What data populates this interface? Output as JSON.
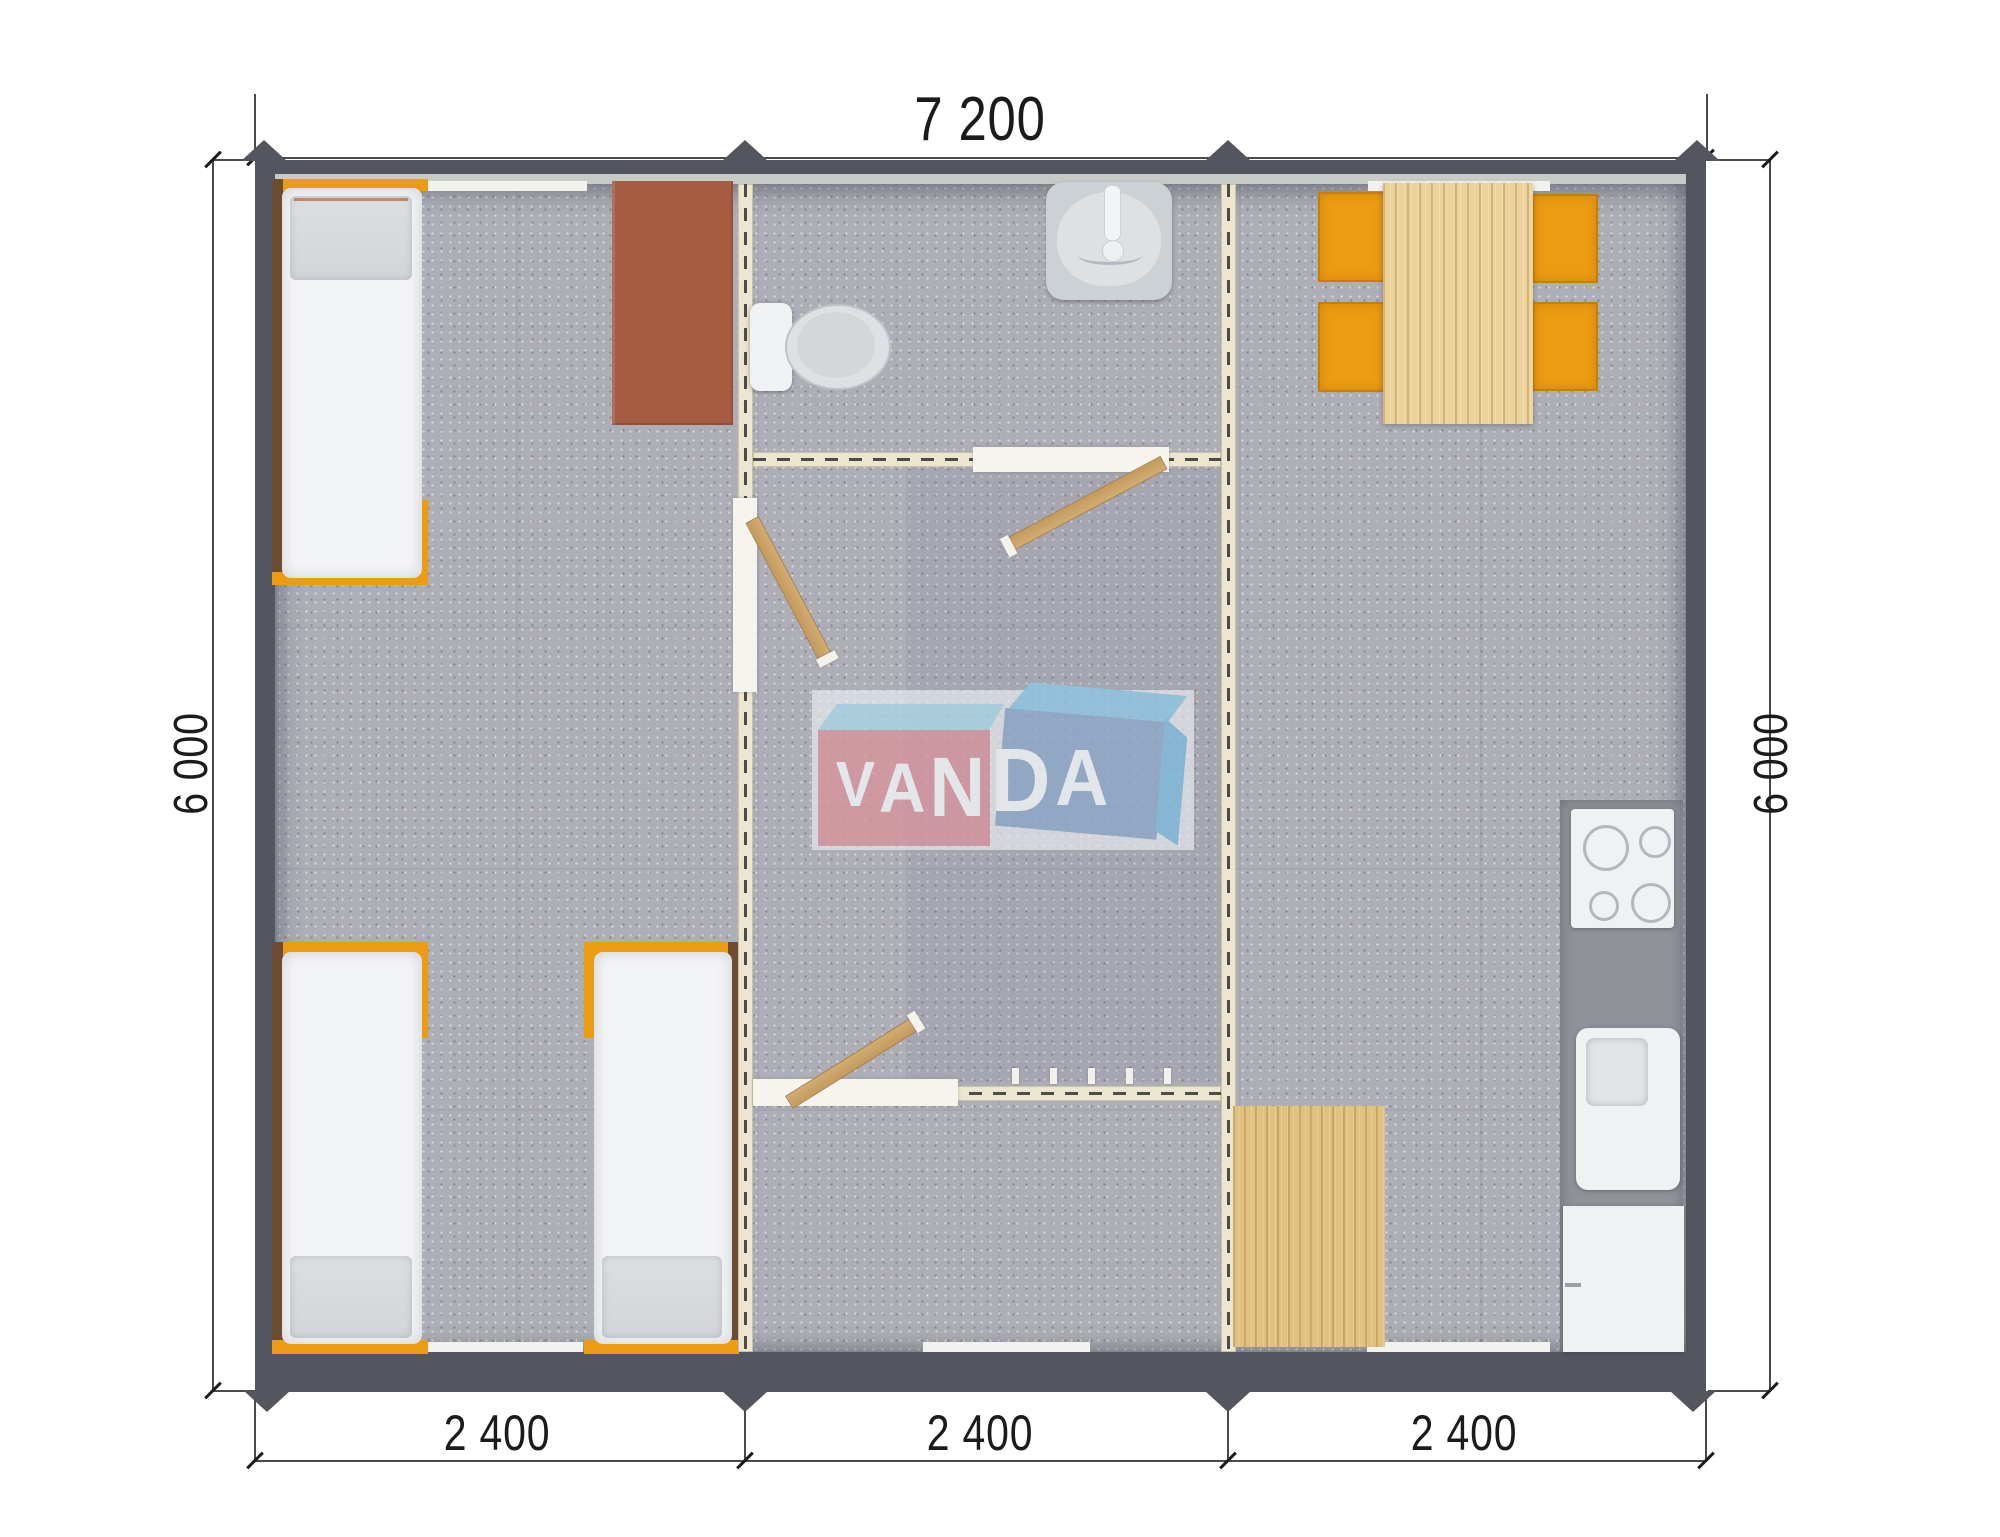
{
  "title": "VANDA modular cabin floor plan",
  "dimensions": {
    "top": "7 200",
    "left": "6 000",
    "right": "6 000",
    "bottom": [
      "2 400",
      "2 400",
      "2 400"
    ]
  },
  "logo": {
    "text": "VANDA",
    "letters": [
      "V",
      "A",
      "N",
      "D",
      "A"
    ]
  },
  "colors": {
    "wall": "#53565f",
    "sill": "#c7cbc5",
    "carpet": "#adaeb6",
    "partition": "#ece5cf",
    "partition_dash": "#4c4c46",
    "door_panel": "#f6f4ee",
    "door_wood": "#c49a5d",
    "orange": "#eb9c12",
    "bed_wood": "#6e4c34",
    "mattress": "#f3f4f6",
    "pillow": "#d2d5d9",
    "desk": "#a75b41",
    "table_wood": "#ecd29b",
    "mat_wood": "#e0c27e",
    "counter": "#8f9298",
    "appliance": "#eff1f3",
    "fixture": "#dde1e4",
    "window": "#f2f2ef",
    "logo_pink": "#d6959f",
    "logo_blue": "#8ea8c8",
    "logo_cyan": "#a9d4e4",
    "logo_text": "#eff3f5",
    "dim_line": "#4a4a4a",
    "dim_text": "#1b1b1b"
  }
}
